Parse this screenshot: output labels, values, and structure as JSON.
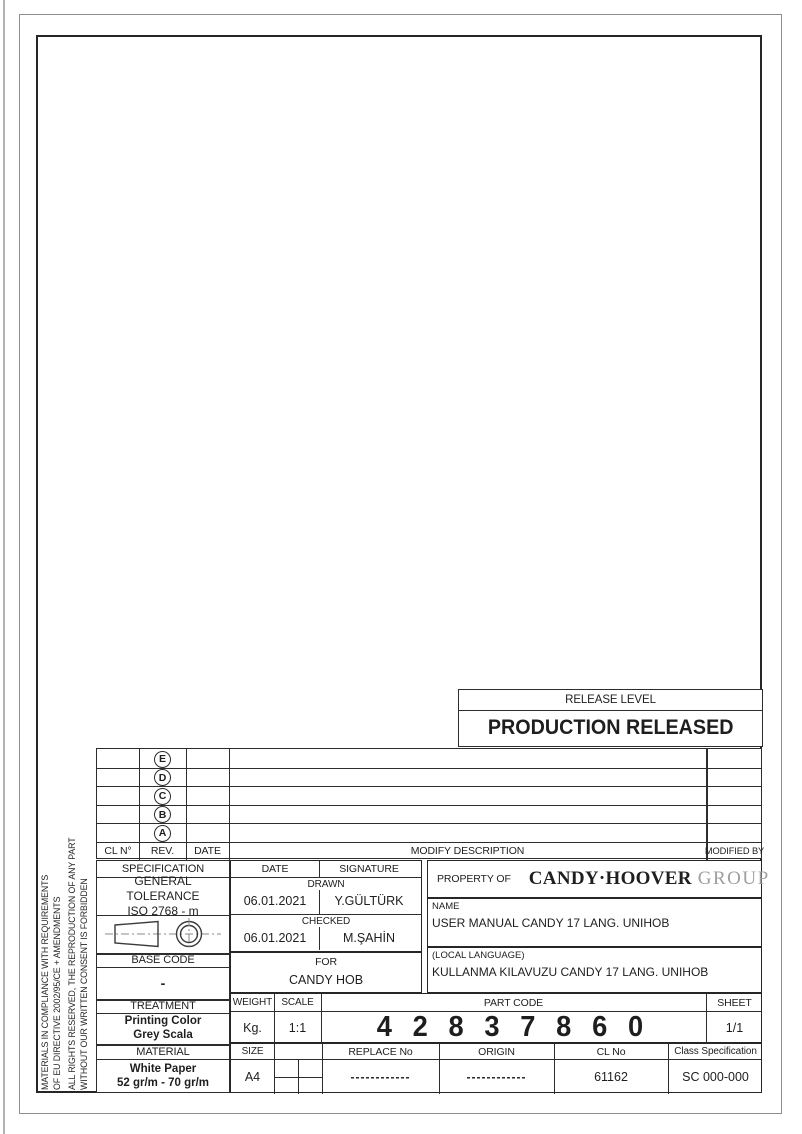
{
  "release_level": {
    "label": "RELEASE LEVEL",
    "status": "PRODUCTION RELEASED"
  },
  "revision_table": {
    "rev_marks": [
      "E",
      "D",
      "C",
      "B",
      "A"
    ],
    "headers": {
      "cl_no": "CL N°",
      "rev": "REV.",
      "date": "DATE",
      "modify_description": "MODIFY DESCRIPTION",
      "modified_by": "MODIFIED BY"
    }
  },
  "compliance_note": {
    "line1": "MATERIALS IN COMPLIANCE WITH REQUIREMENTS",
    "line2": "OF EU DIRECTIVE 2002/95/CE + AMENDMENTS",
    "line3": "ALL RIGHTS RESERVED, THE REPRODUCTION OF ANY PART",
    "line4": "WITHOUT OUR WRITTEN CONSENT IS FORBIDDEN"
  },
  "specification": {
    "label": "SPECIFICATION",
    "general_tolerance": "GENERAL TOLERANCE",
    "tolerance_standard": "ISO 2768 - m",
    "projection_symbol": "first-angle-projection-icon"
  },
  "base_code": {
    "label": "BASE CODE",
    "value": "-"
  },
  "treatment": {
    "label": "TREATMENT",
    "line1": "Printing Color",
    "line2": "Grey Scala"
  },
  "material": {
    "label": "MATERIAL",
    "line1": "White Paper",
    "line2": "52 gr/m - 70 gr/m"
  },
  "signoff": {
    "date_header": "DATE",
    "signature_header": "SIGNATURE",
    "drawn": {
      "label": "DRAWN",
      "date": "06.01.2021",
      "signature": "Y.GÜLTÜRK"
    },
    "checked": {
      "label": "CHECKED",
      "date": "06.01.2021",
      "signature": "M.ŞAHİN"
    }
  },
  "property_of": {
    "label": "PROPERTY OF",
    "brand": "CANDY·HOOVER",
    "brand_suffix": "GROUP",
    "logo": "candy-logo-badge"
  },
  "name": {
    "label": "NAME",
    "value": "USER MANUAL CANDY 17 LANG. UNIHOB"
  },
  "for_product": {
    "label": "FOR",
    "value": "CANDY HOB"
  },
  "local_language": {
    "label": "(LOCAL LANGUAGE)",
    "value": "KULLANMA KILAVUZU CANDY 17 LANG. UNIHOB"
  },
  "weight": {
    "label": "WEIGHT",
    "value": "Kg."
  },
  "scale": {
    "label": "SCALE",
    "value": "1:1"
  },
  "part_code": {
    "label": "PART CODE",
    "value": "4 2 8 3 7 8 6 0"
  },
  "sheet": {
    "label": "SHEET",
    "value": "1/1"
  },
  "size": {
    "label": "SIZE",
    "value": "A4"
  },
  "replace_no": {
    "label": "REPLACE No",
    "value": "------------"
  },
  "origin": {
    "label": "ORIGIN",
    "value": "------------"
  },
  "cl_no": {
    "label": "CL No",
    "value": "61162"
  },
  "class_specification": {
    "label": "Class Specification",
    "value": "SC 000-000"
  },
  "colors": {
    "line": "#2d2d2d",
    "brand_red": "#cf2030",
    "brand_grey": "#9e9e9e"
  }
}
